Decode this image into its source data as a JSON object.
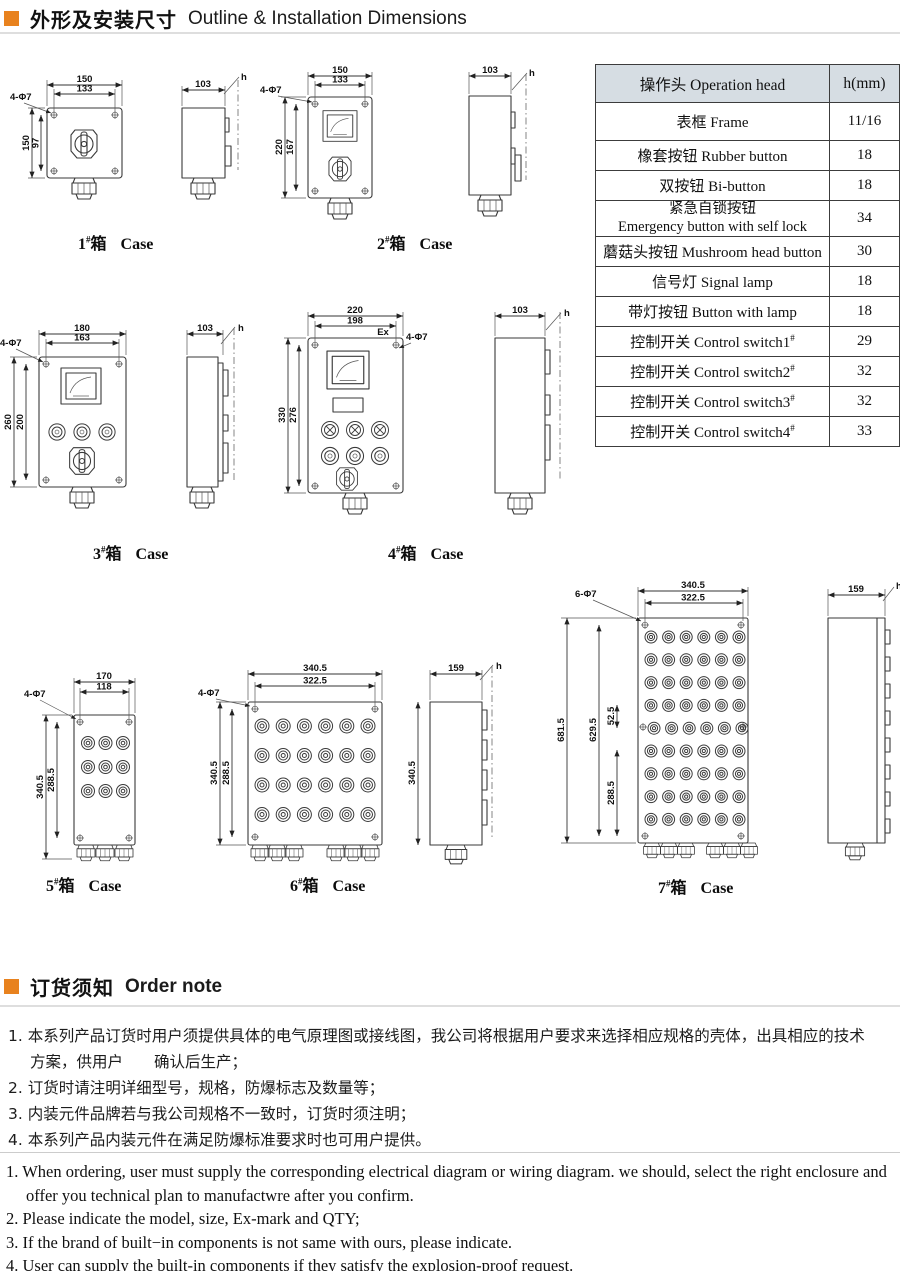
{
  "page": {
    "accent_color": "#e8821e",
    "table_header_bg": "#d6dde3"
  },
  "section_outline": {
    "title_zh": "外形及安装尺寸",
    "title_en": "Outline & Installation Dimensions"
  },
  "section_order": {
    "title_zh": "订货须知",
    "title_en": "Order note"
  },
  "table": {
    "header": {
      "col1": "操作头 Operation head",
      "col2": "h(mm)"
    },
    "rows": [
      {
        "name": "表框  Frame",
        "sup": "",
        "h": "11/16"
      },
      {
        "name": "橡套按钮  Rubber button",
        "sup": "",
        "h": "18"
      },
      {
        "name": "双按钮 Bi-button",
        "sup": "",
        "h": "18"
      },
      {
        "name": "紧急自锁按钮\nEmergency button with self lock",
        "sup": "",
        "h": "34"
      },
      {
        "name": "蘑菇头按钮 Mushroom head button",
        "sup": "",
        "h": "30"
      },
      {
        "name": "信号灯 Signal lamp",
        "sup": "",
        "h": "18"
      },
      {
        "name": "带灯按钮 Button with lamp",
        "sup": "",
        "h": "18"
      },
      {
        "name": "控制开关 Control switch1",
        "sup": "#",
        "h": "29"
      },
      {
        "name": "控制开关 Control switch2",
        "sup": "#",
        "h": "32"
      },
      {
        "name": "控制开关 Control switch3",
        "sup": "#",
        "h": "32"
      },
      {
        "name": "控制开关 Control switch4",
        "sup": "#",
        "h": "33"
      }
    ]
  },
  "cases": {
    "c1": {
      "label": {
        "num": "1",
        "hash": "#",
        "box": "箱",
        "case": "Case"
      },
      "dims": {
        "top_outer": "150",
        "top_inner": "133",
        "left_outer": "150",
        "left_inner": "97",
        "holes": "4-Φ7",
        "side_w": "103",
        "side_h": "h"
      }
    },
    "c2": {
      "label": {
        "num": "2",
        "hash": "#",
        "box": "箱",
        "case": "Case"
      },
      "dims": {
        "top_outer": "150",
        "top_inner": "133",
        "left_outer": "220",
        "left_inner": "167",
        "holes": "4-Φ7",
        "side_w": "103",
        "side_h": "h"
      }
    },
    "c3": {
      "label": {
        "num": "3",
        "hash": "#",
        "box": "箱",
        "case": "Case"
      },
      "dims": {
        "top_outer": "180",
        "top_inner": "163",
        "left_outer": "260",
        "left_inner": "200",
        "holes": "4-Φ7",
        "side_w": "103",
        "side_h": "h"
      }
    },
    "c4": {
      "label": {
        "num": "4",
        "hash": "#",
        "box": "箱",
        "case": "Case"
      },
      "dims": {
        "top_outer": "220",
        "top_inner": "198",
        "left_outer": "330",
        "left_inner": "276",
        "holes": "4-Φ7",
        "ex": "Ex",
        "side_w": "103",
        "side_h": "h"
      }
    },
    "c5": {
      "label": {
        "num": "5",
        "hash": "#",
        "box": "箱",
        "case": "Case"
      },
      "dims": {
        "top_outer": "170",
        "top_inner": "118",
        "left_outer": "340.5",
        "left_inner": "288.5",
        "holes": "4-Φ7"
      }
    },
    "c6": {
      "label": {
        "num": "6",
        "hash": "#",
        "box": "箱",
        "case": "Case"
      },
      "dims": {
        "top_outer": "340.5",
        "top_inner": "322.5",
        "left_outer": "340.5",
        "left_inner": "288.5",
        "holes": "4-Φ7",
        "side_w": "159",
        "side_h": "h",
        "side_height": "340.5"
      }
    },
    "c7": {
      "label": {
        "num": "7",
        "hash": "#",
        "box": "箱",
        "case": "Case"
      },
      "dims": {
        "top_outer": "340.5",
        "top_inner": "322.5",
        "left_outer": "681.5",
        "left_inner": "629.5",
        "seg_mid": "52.5",
        "seg_low": "288.5",
        "holes": "6-Φ7",
        "side_w": "159",
        "side_h": "h"
      }
    }
  },
  "order_notes": {
    "zh": [
      "1. 本系列产品订货时用户须提供具体的电气原理图或接线图，我公司将根据用户要求来选择相应规格的壳体，出具相应的技术",
      "方案，供用户　　确认后生产；",
      "2. 订货时请注明详细型号，规格，防爆标志及数量等；",
      "3. 内装元件品牌若与我公司规格不一致时，订货时须注明；",
      "4. 本系列产品内装元件在满足防爆标准要求时也可用户提供。"
    ],
    "en": [
      "1. When ordering, user must supply the corresponding electrical diagram or wiring diagram. we should, select the right enclosure and",
      "offer you technical plan to manufactwre after you confirm.",
      "2. Please indicate the model, size, Ex-mark and QTY;",
      "3. If the brand of built−in components is not same with ours, please indicate.",
      "4. User can supply the built-in components if they satisfy the explosion-proof request."
    ]
  }
}
